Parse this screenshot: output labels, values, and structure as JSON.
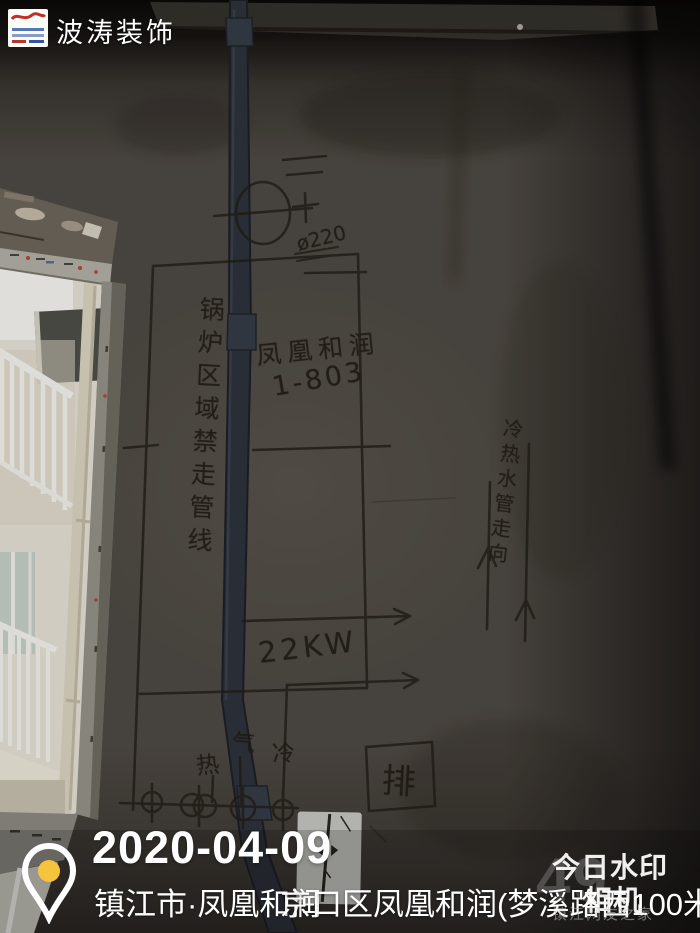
{
  "branding": {
    "name": "波涛装饰"
  },
  "wall": {
    "diameter_note": "ø220",
    "boiler_note": "锅炉区域禁走管线",
    "project_name": "凤凰和润",
    "unit": "1-803",
    "power": "22KW",
    "pipe_note": "冷热水管走向",
    "hot": "热",
    "gas": "气",
    "cold": "冷",
    "drain": "排"
  },
  "watermark": {
    "date": "2020-04-09",
    "city_line": "镇江市·凤凰和润",
    "address_line": "京口区凤凰和润(梦溪路西100米)",
    "app_line1": "今日水印",
    "app_line2": "相机",
    "forum": "镇江网友之家",
    "post_no": "49",
    "pin_color": "#f6c33d"
  }
}
